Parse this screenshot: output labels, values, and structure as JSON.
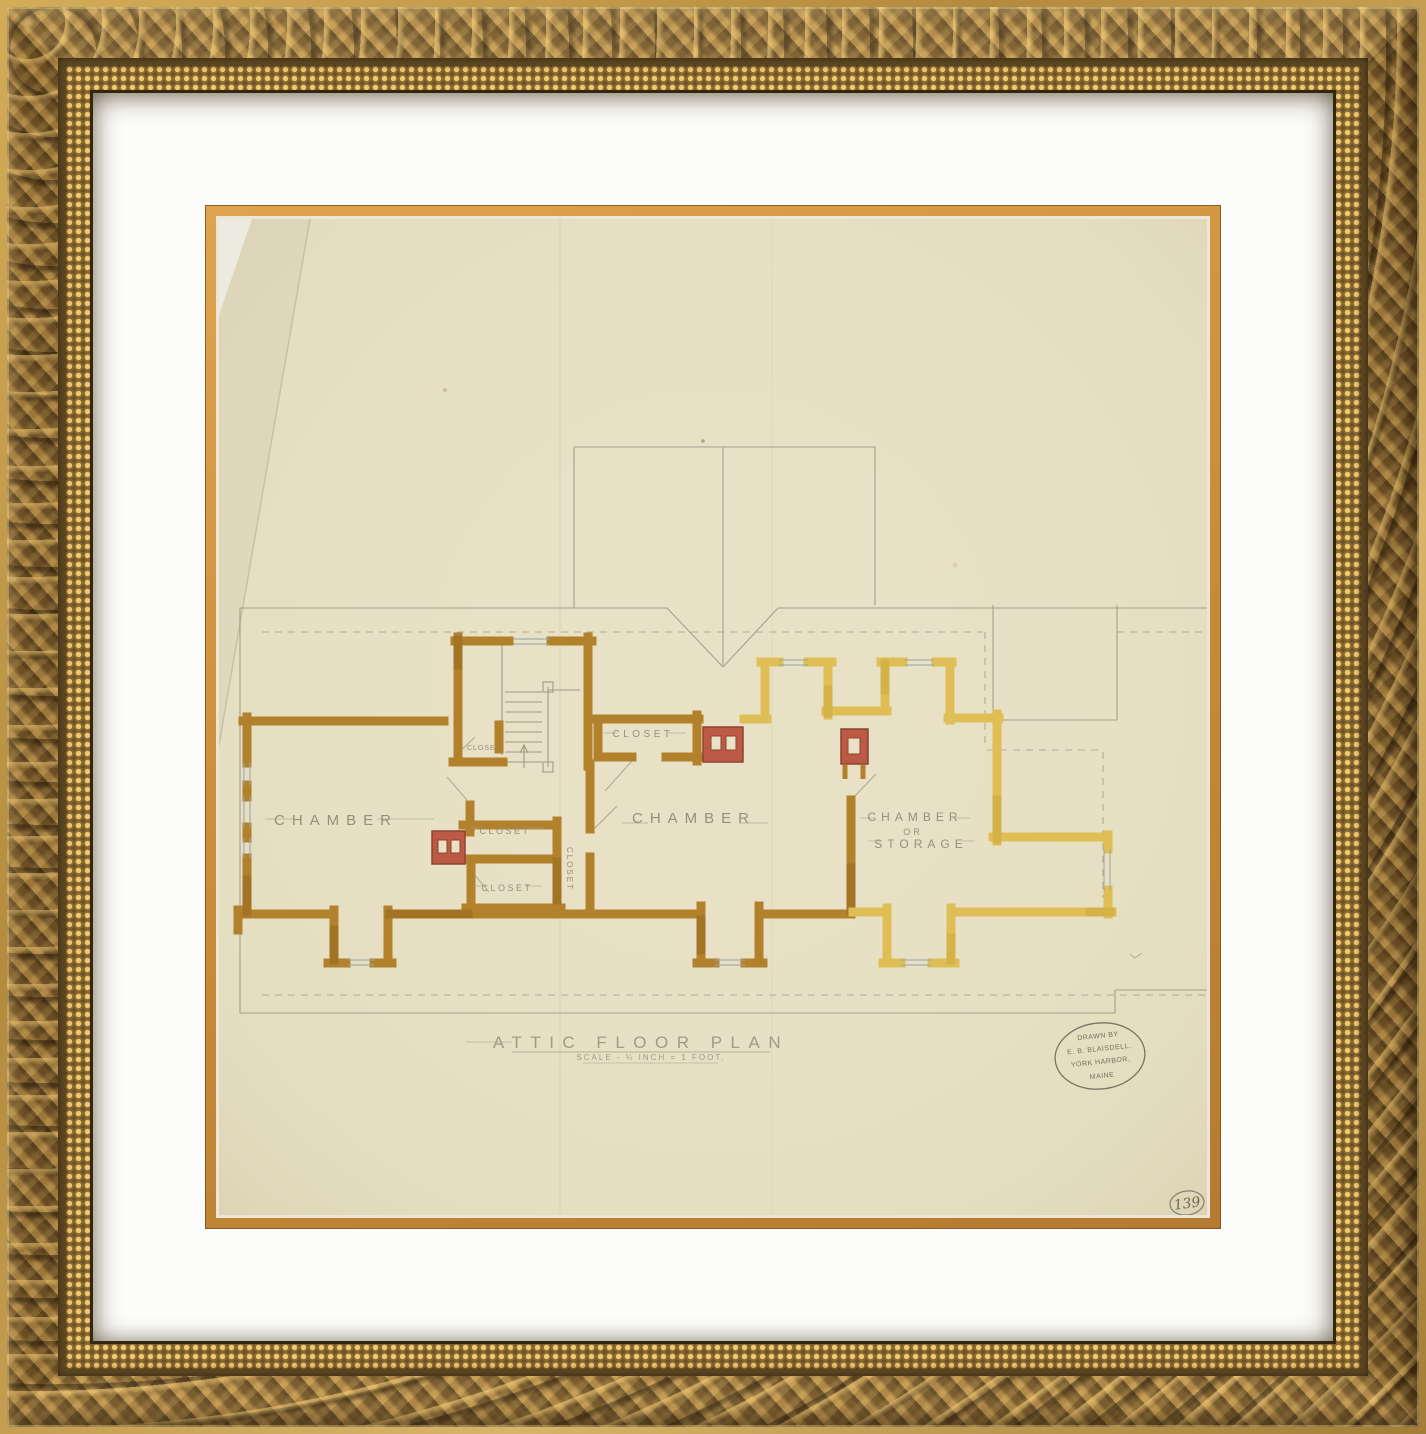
{
  "frame": {
    "style": "ornate-gold-baroque",
    "gold_color": "#8a6a38",
    "mat_color": "#fcfcfa",
    "fillet_color": "#c98f3c"
  },
  "drawing": {
    "title": "ATTIC FLOOR PLAN",
    "scale_note": "SCALE - ¼ INCH = 1 FOOT.",
    "page_number": "139",
    "stamp_lines": [
      "DRAWN BY",
      "E. B. BLAISDELL,",
      "YORK HARBOR,",
      "MAINE"
    ],
    "labels": {
      "chamber_left": "CHAMBER",
      "chamber_center": "CHAMBER",
      "chamber_right_line1": "CHAMBER",
      "chamber_right_line2": "OR",
      "chamber_right_line3": "STORAGE",
      "closet_at_stairs": "CLOSET",
      "closet_hall": "CLOSET",
      "closet_upper": "CLOSET",
      "closet_lower": "CLOSET",
      "closet_corridor": "CLOSET"
    },
    "colors": {
      "paper": "#e8e1c5",
      "wall_dark": "#b2812b",
      "wall_light": "#dfbf55",
      "chimney_red": "#bc5a45",
      "pencil": "#8e8878"
    }
  }
}
